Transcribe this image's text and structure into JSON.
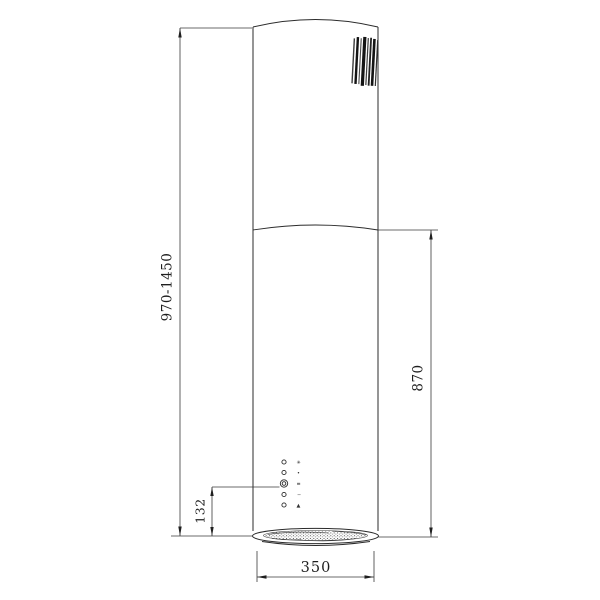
{
  "drawing": {
    "dimensions": {
      "overall_height_range": "970-1450",
      "body_height": "870",
      "control_panel_offset": "132",
      "diameter": "350"
    },
    "controls": {
      "button_count": "5",
      "symbols": [
        "✳",
        "•",
        "≡",
        "−",
        "▲"
      ]
    },
    "colors": {
      "line": "#2b2b2b",
      "dimension_line": "#3a3a3a",
      "background": "#ffffff",
      "barcode": "#141414"
    }
  }
}
